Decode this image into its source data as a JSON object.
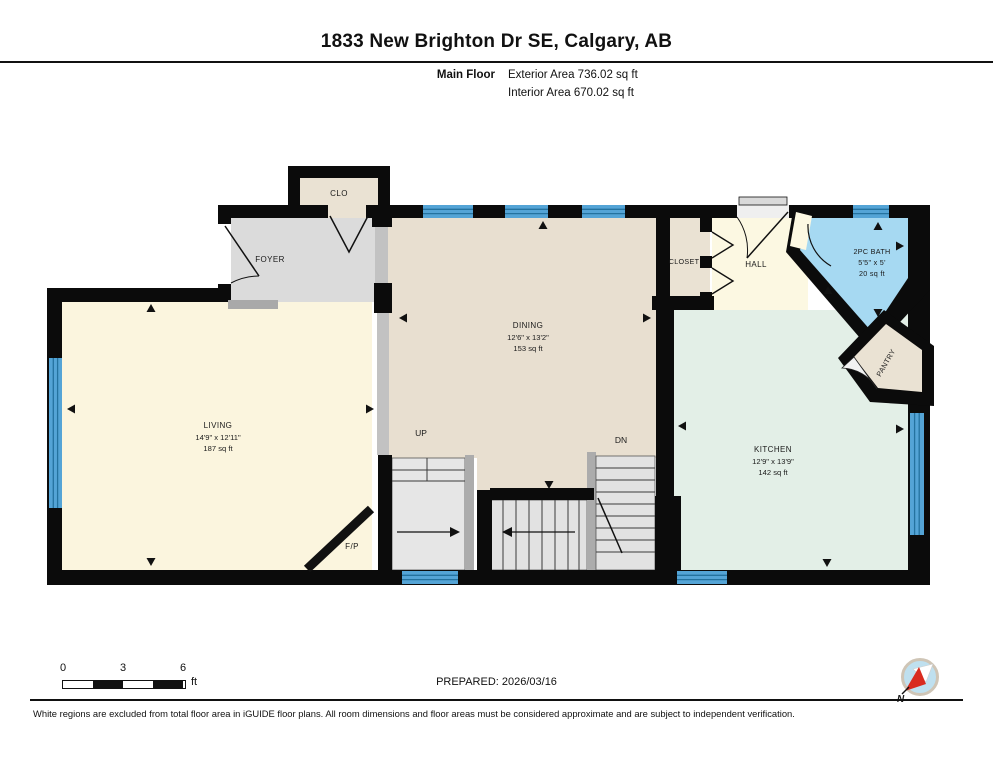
{
  "header": {
    "title": "1833 New Brighton Dr SE, Calgary, AB",
    "floor_label": "Main Floor",
    "exterior_area": "Exterior Area 736.02 sq ft",
    "interior_area": "Interior Area 670.02 sq ft"
  },
  "rooms": {
    "clo": {
      "label": "CLO"
    },
    "foyer": {
      "label": "FOYER"
    },
    "living": {
      "label": "LIVING",
      "dims": "14'9\" x 12'11\"",
      "area": "187 sq ft"
    },
    "dining": {
      "label": "DINING",
      "dims": "12'6\" x 13'2\"",
      "area": "153 sq ft"
    },
    "closet": {
      "label": "CLOSET"
    },
    "hall": {
      "label": "HALL"
    },
    "bath": {
      "label": "2PC BATH",
      "dims": "5'5\" x 5'",
      "area": "20 sq ft"
    },
    "pantry": {
      "label": "PANTRY"
    },
    "kitchen": {
      "label": "KITCHEN",
      "dims": "12'9\" x 13'9\"",
      "area": "142 sq ft"
    },
    "fireplace": {
      "label": "F/P"
    }
  },
  "stairs": {
    "up_label": "UP",
    "down_label": "DN"
  },
  "scale_bar": {
    "tick0": "0",
    "tick1": "3",
    "tick2": "6",
    "unit": "ft"
  },
  "footer": {
    "prepared": "PREPARED: 2026/03/16",
    "compass_label": "N",
    "disclaimer": "White regions are excluded from total floor area in iGUIDE floor plans. All room dimensions and floor areas must be considered approximate and are subject to independent verification."
  },
  "colors": {
    "wall": "#0b0b0b",
    "living": "#FBF5DE",
    "dining": "#E8DFD0",
    "kitchen": "#E3EFE7",
    "foyer": "#DBDBDB",
    "closet_beige": "#EAE2D3",
    "hall": "#FCF8E2",
    "bath": "#A6D9F2",
    "window": "#54A4D6",
    "window_stripe": "#24729F",
    "stairs": "#E4E4E4",
    "railing": "#ACACAC",
    "half_wall": "#C2C2C2"
  }
}
